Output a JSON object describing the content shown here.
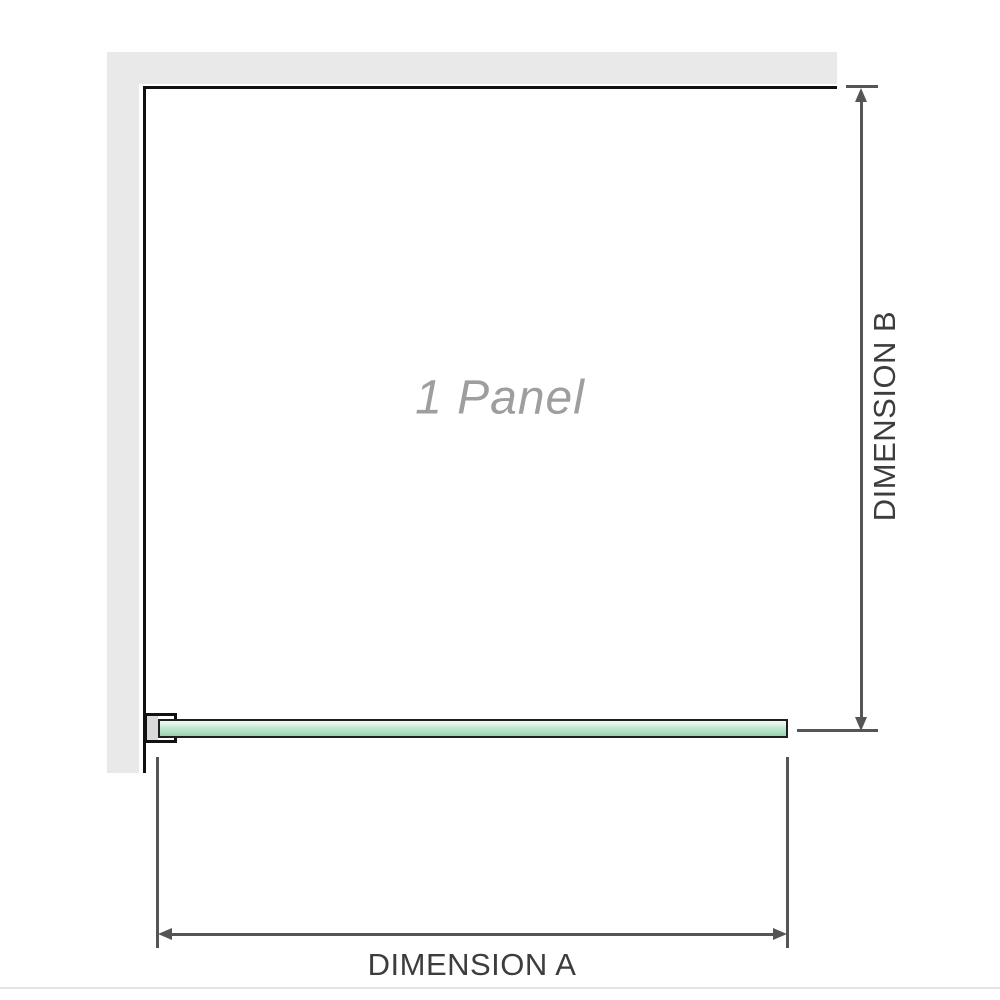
{
  "diagram": {
    "title": "1 Panel",
    "dimensions": {
      "a_label": "DIMENSION A",
      "b_label": "DIMENSION B"
    },
    "colors": {
      "wall": "#e9e9e9",
      "panel_outline": "#111111",
      "glass_fill": "#b7e1c8",
      "glass_highlight": "#f0f9f3",
      "glass_shadow": "#97d1ae",
      "glass_outline": "#1f1f1f",
      "bracket_pad": "#d9d9d9",
      "dimension_line": "#555555",
      "dimension_text": "#3d3d3d",
      "watermark_text": "#9e9e9e",
      "baseline": "#e4e4e4"
    }
  }
}
